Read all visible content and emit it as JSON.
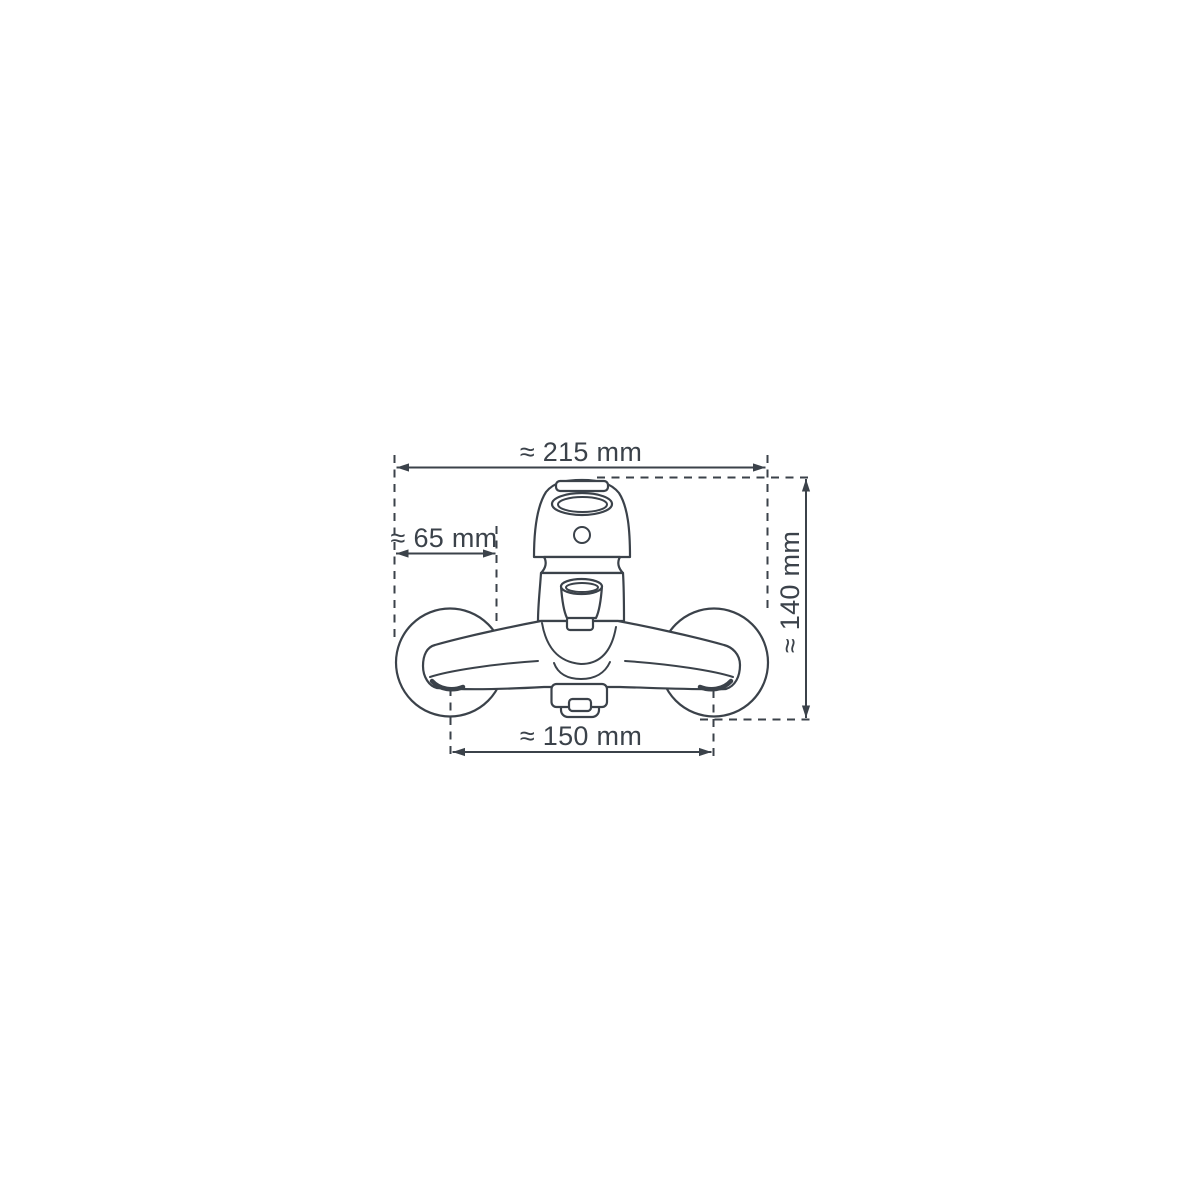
{
  "page": {
    "background_color": "#ffffff",
    "line_color": "#3b424a"
  },
  "drawing": {
    "name": "wall-mounted-bath-mixer-tap-front-view",
    "dimensions": {
      "top_width": "≈ 215 mm",
      "left_width": "≈ 65 mm",
      "right_height": "≈ 140 mm",
      "bottom_width": "≈ 150 mm"
    }
  }
}
